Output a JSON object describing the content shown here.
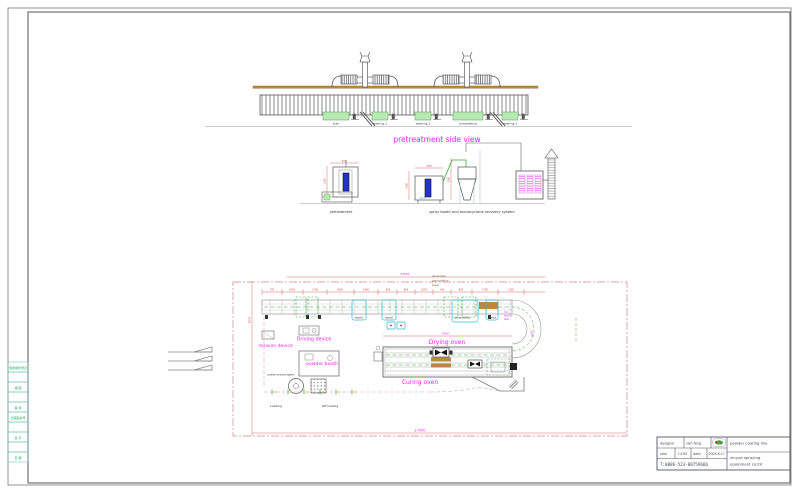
{
  "sheet": {
    "left_strip": [
      "借通用件登记",
      "",
      "描 图",
      "",
      "审 核",
      "旧底图总号",
      "",
      "签 字",
      "",
      "日 期"
    ]
  },
  "side_view": {
    "title": "pretreatment side view",
    "tanks": [
      "skim",
      "washing 1",
      "washing 2",
      "phosphating",
      "washing 3"
    ]
  },
  "sections": {
    "left_label": "pretreatment",
    "right_label": "spray booth and monocyclone recovery system",
    "dims": {
      "booth_h": "2350",
      "booth_w": "900",
      "spray_h": "2500",
      "spray_w": "1500",
      "cyclone_h": "3200"
    }
  },
  "plan": {
    "tower_note_lines": [
      "phosphate",
      "precipitation",
      "tower"
    ],
    "labels": {
      "tension": "tension device",
      "driving": "Driving device",
      "powder_booth": "powder booth",
      "powder_recovery": "powder recovery system",
      "drying": "Drying oven",
      "curing": "Curing oven",
      "loading": "Loading",
      "offloading": "Off loading",
      "wash1": "wash1",
      "wash2": "wash2",
      "phosphating": "phosphating",
      "wash3": "wash3",
      "hot_tank_lines": [
        "hot",
        "recycle",
        "tank"
      ]
    },
    "dims": {
      "overall_top": "24050",
      "overall_bottom": "27000",
      "left_vertical": "4500",
      "oven": "7000",
      "turn": "5000",
      "segments": [
        "700",
        "1550",
        "1700",
        "3000",
        "1450",
        "850",
        "800",
        "1643",
        "140",
        "800",
        "1700",
        "1250"
      ]
    }
  },
  "title_block": {
    "designer_label": "designer",
    "designer_name": "jain feng",
    "rate_label": "rate",
    "rate_value": "1:100",
    "date_label": "date",
    "date_value": "2005.6.17",
    "phone": "T:0086-523-88759666",
    "product": "powder coating line",
    "company_lines": [
      "xinyue spraying",
      "equipment co.ltd"
    ]
  },
  "colors": {
    "magenta": "#ee22ee",
    "red_dim": "#cc4444",
    "cyan": "#33bbcc",
    "green": "#33aa33",
    "tan": "#bb8844",
    "blue": "#2233cc",
    "light_green": "#b6eab0"
  }
}
